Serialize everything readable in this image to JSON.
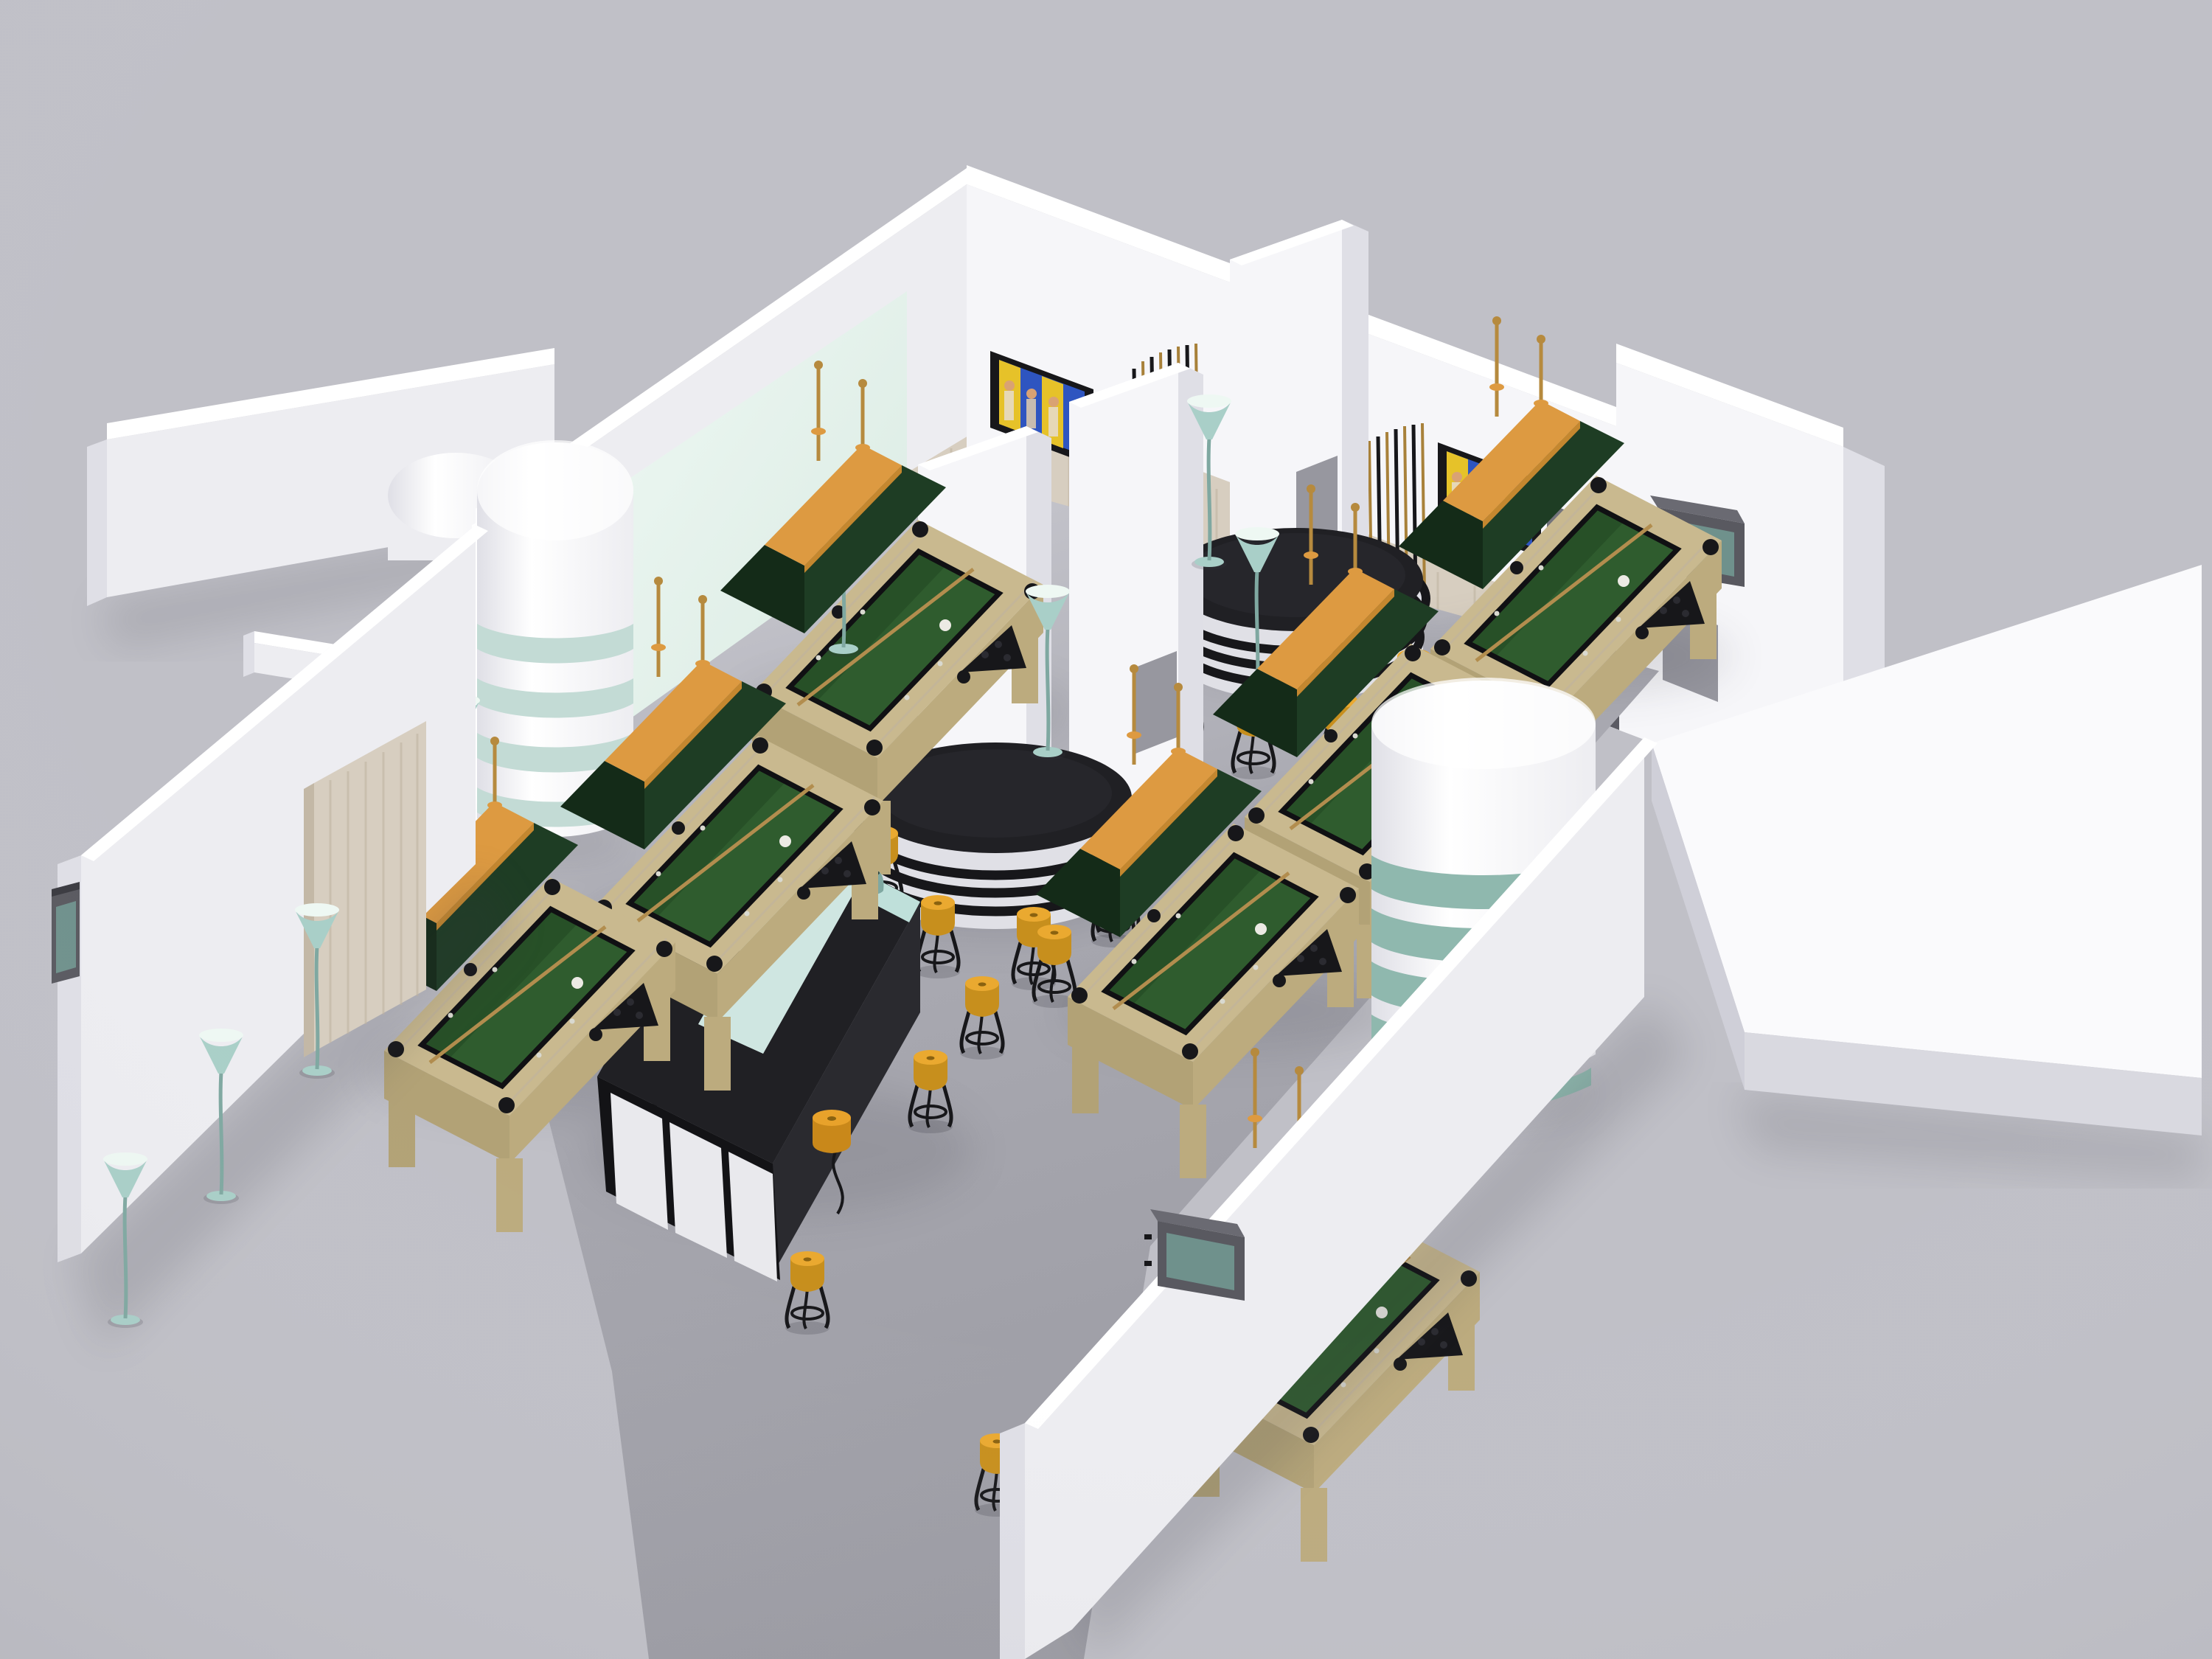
{
  "scene": {
    "title": "Billiard club interior – 3D visualization",
    "subject": "Isometric cutaway render of a billiard club with pool tables, central black bar, column bars and glass cylinders",
    "view": "isometric overhead cutaway",
    "inventory": {
      "pool_tables": 8,
      "hanging_table_lamps": 8,
      "bar_stools": 16,
      "trumpet_floor_lamps": 8,
      "wall_screens_exterior": 3,
      "wall_pictures_interior": 2,
      "white_columns": 3,
      "glass_band_cylinders": 3,
      "round_column_bars": 2,
      "central_u_bar": 1,
      "cue_racks": 2,
      "wood_wall_panels": 3,
      "armchairs": 2,
      "doorways": 1
    }
  },
  "colors": {
    "bg": "#c0c0c7",
    "floor": "#a9a9b1",
    "floor_dark": "#9b9ba3",
    "wall_bright": "#f6f6f9",
    "wall_mid": "#ededf1",
    "wall_shade": "#dfdfe6",
    "wall_top": "#ffffff",
    "wall_side": "#cfcfd6",
    "glass_pane": "#d9eae2",
    "glass_pane_hi": "#eef8f3",
    "wood_panel": "#d7cec0",
    "wood_grain": "#bfb3a0",
    "wood_rail": "#c9b98f",
    "wood_rail_dark": "#b2a276",
    "wood_apron": "#bcab7e",
    "felt": "#2f5c2e",
    "felt_dark": "#1e421f",
    "cushion": "#101013",
    "lamp_green": "#1e3d24",
    "lamp_green_dark": "#142b18",
    "lamp_wood": "#dd9a41",
    "brass": "#b68a3e",
    "stool_top": "#eaa930",
    "stool_side": "#c78f1d",
    "stool_dark": "#8a6210",
    "metal_black": "#17171a",
    "bar_black": "#202024",
    "bar_black_side": "#2a2a2f",
    "bar_front_dark": "#131316",
    "panel_white": "#e9e9ed",
    "teal_glass": "#cfe6e1",
    "teal_strip": "#bfe0da",
    "teal_band": "#8fb8ae",
    "teal_band_soft": "#c3dbd5",
    "teal_lamp": "#a9cfc8",
    "teal_lamp_dark": "#7fa8a1",
    "platform_top": "#fafafc",
    "platform_edge": "#d9d9e0",
    "doorway": "#73737b",
    "doorway_dark": "#5b5b63",
    "tv_frame": "#595960",
    "tv_screen": "#6f918c",
    "abba_blue": "#2e55c0",
    "abba_yellow": "#e6c229",
    "abba_skin": "#d9a273",
    "gray_panel": "#97979f",
    "chair_gray": "#b4b4bc",
    "chair_light": "#d8d8de",
    "shadow": "#3a3a44"
  }
}
